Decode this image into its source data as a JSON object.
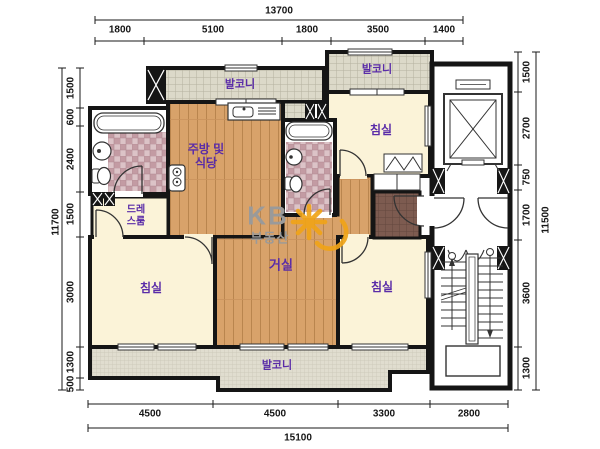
{
  "rooms": {
    "balcony_top_left": "발코니",
    "balcony_top_right": "발코니",
    "balcony_bottom": "발코니",
    "kitchen_line1": "주방 및",
    "kitchen_line2": "식당",
    "dressroom_line1": "드레",
    "dressroom_line2": "스룸",
    "bedroom_left": "침실",
    "bedroom_top_right": "침실",
    "bedroom_bottom_right": "침실",
    "living_room": "거실"
  },
  "watermark": {
    "brand": "KB",
    "brand_sub": "부동산",
    "logo_color": "#f0a418",
    "text_color": "#9a9a9a"
  },
  "dimensions": {
    "top": {
      "total": "13700",
      "segments": [
        "1800",
        "5100",
        "1800",
        "3500",
        "1400"
      ]
    },
    "bottom": {
      "total": "15100",
      "segments": [
        "4500",
        "4500",
        "3300",
        "2800"
      ]
    },
    "left": {
      "total": "11700",
      "segments": [
        "1500",
        "600",
        "2400",
        "1500",
        "3000",
        "1300",
        "500"
      ]
    },
    "right": {
      "total": "11500",
      "segments": [
        "1500",
        "2700",
        "750",
        "1700",
        "3600",
        "1300"
      ]
    }
  },
  "colors": {
    "wall": "#151515",
    "label": "#5a2ca8",
    "wood_floor": "#d8a26a",
    "cream_floor": "#fbf3d8",
    "balcony_tile": "#dcd9c9",
    "bath_tile": "#c79fa6",
    "entry_tile": "#7d5b50"
  }
}
